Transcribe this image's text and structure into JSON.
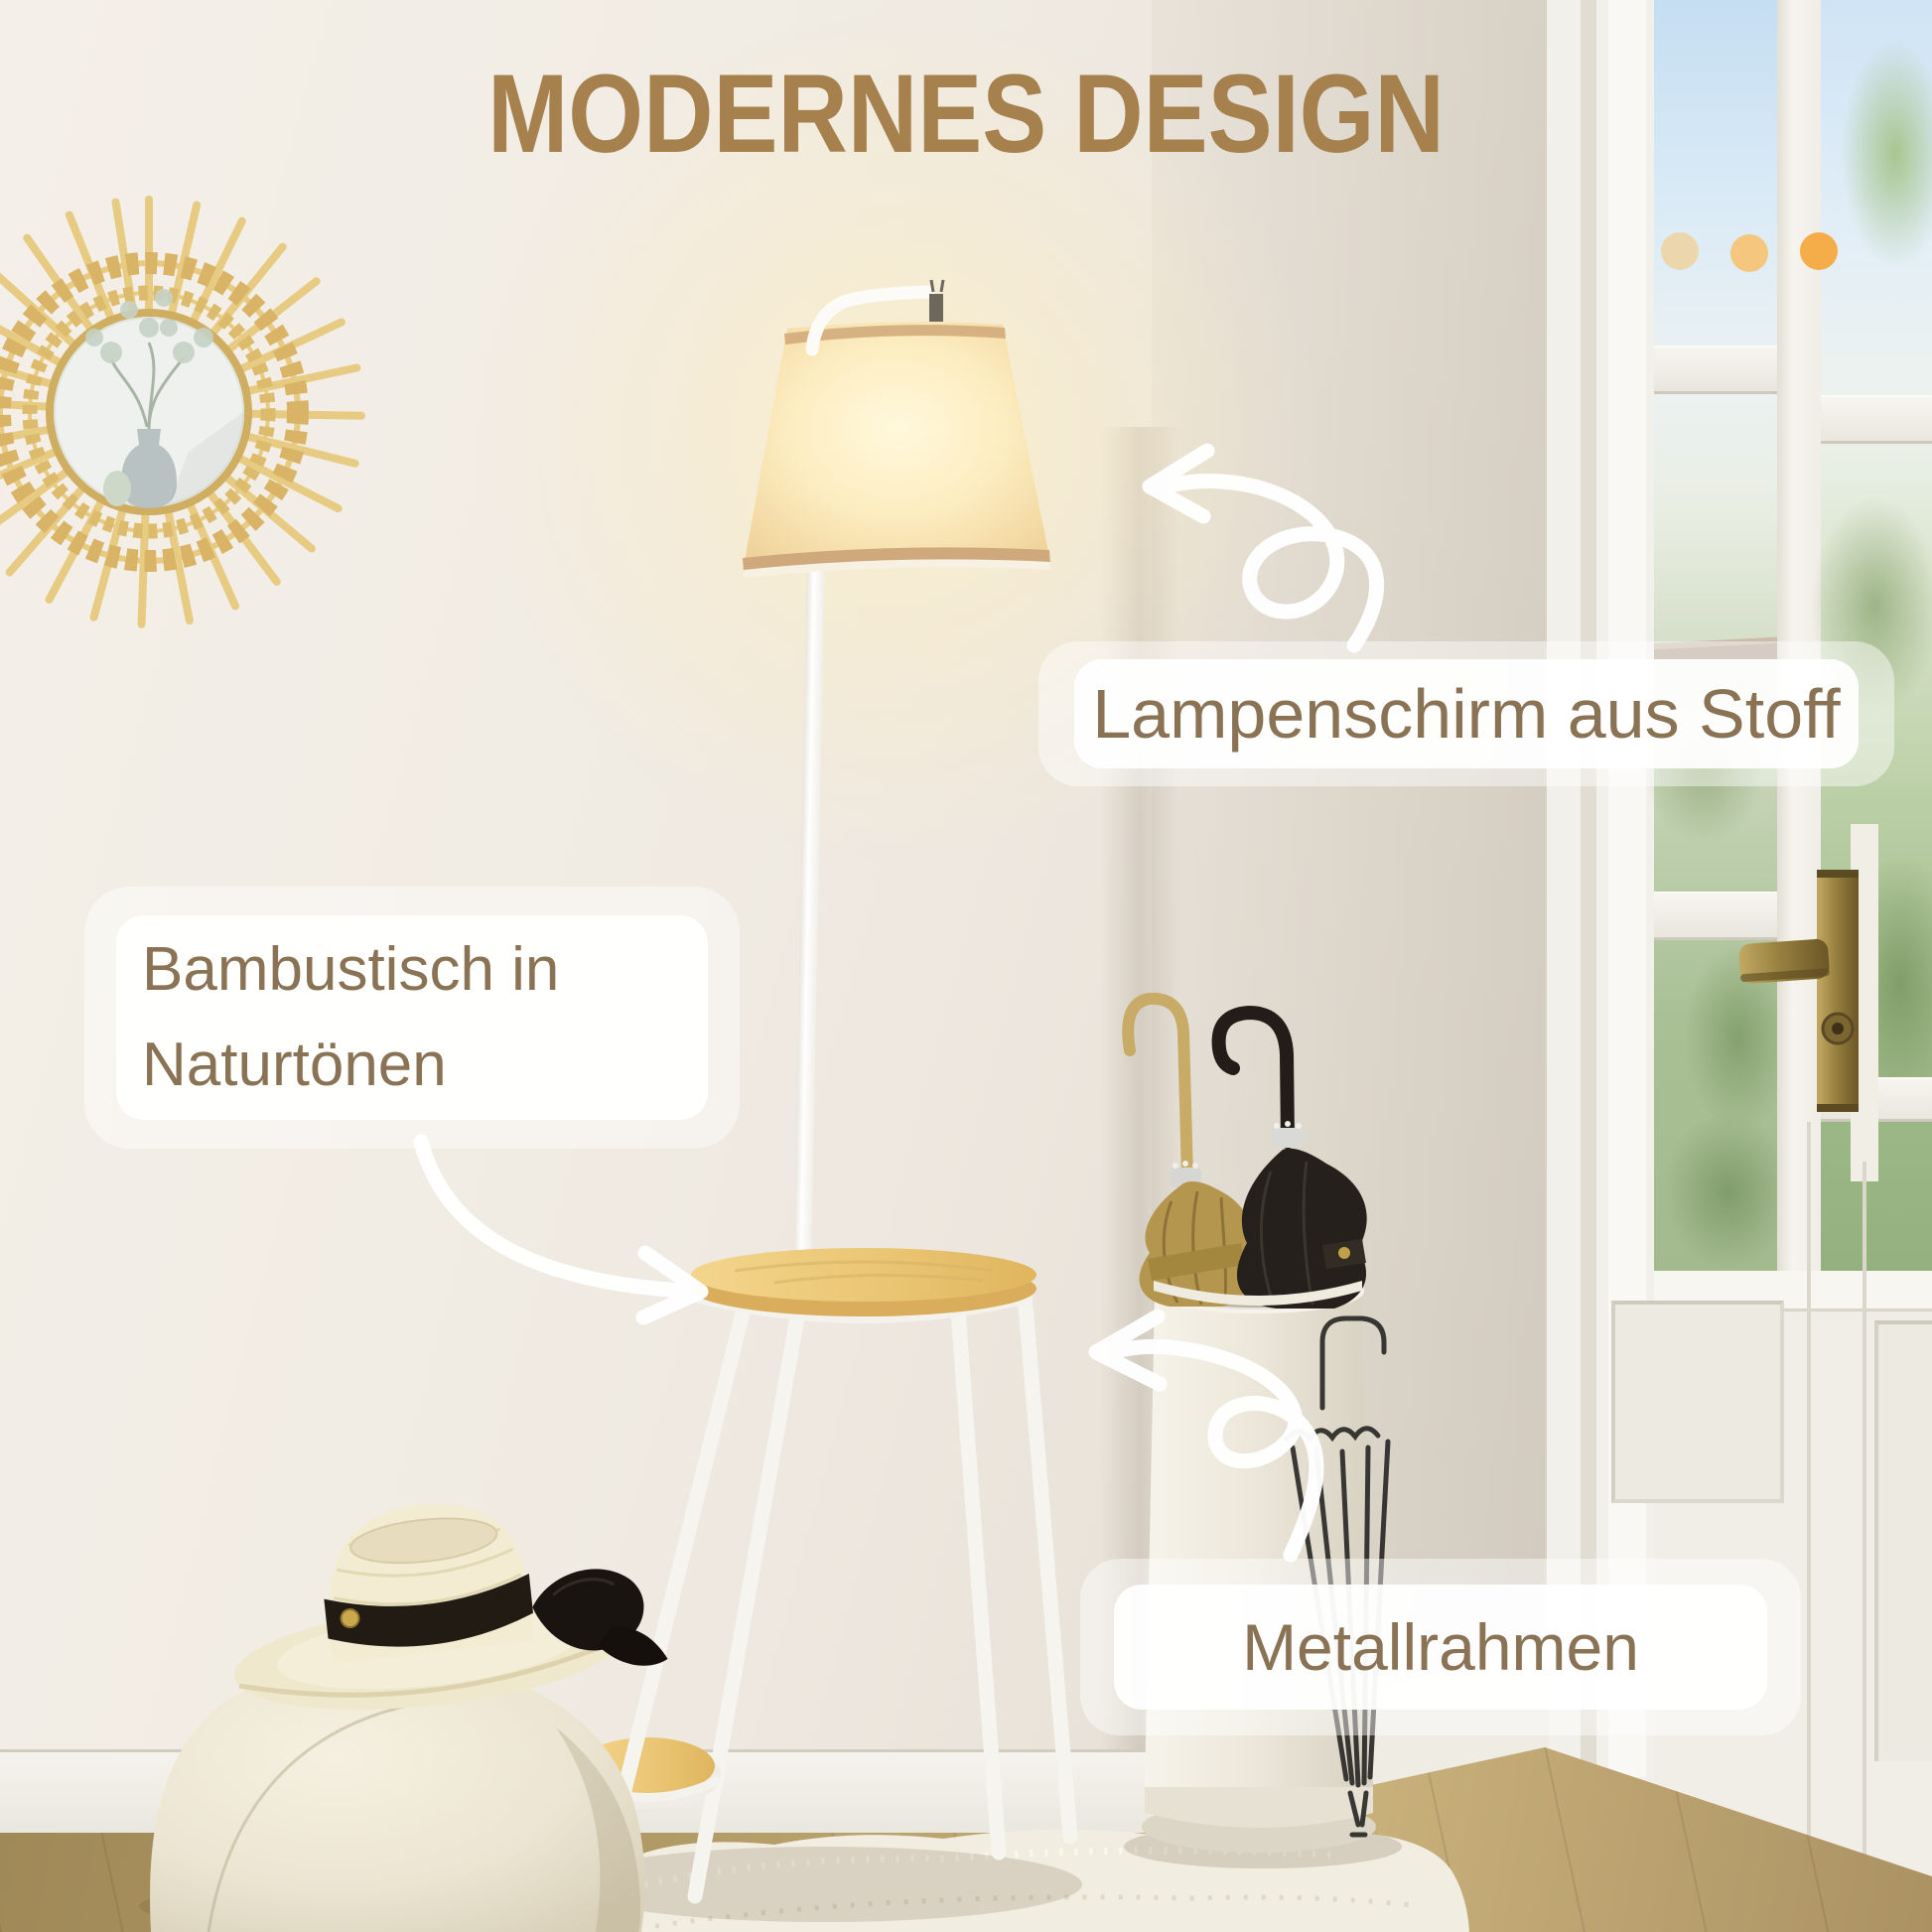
{
  "title": "MODERNES DESIGN",
  "decor_dots": [
    {
      "name": "accent-dot-light",
      "color": "#ecd7ac"
    },
    {
      "name": "accent-dot-medium",
      "color": "#f5c67d"
    },
    {
      "name": "accent-dot-strong",
      "color": "#f5ad4a"
    }
  ],
  "callouts": {
    "lampshade": "Lampenschirm aus Stoff",
    "table": "Bambustisch in Naturtönen",
    "frame": "Metallrahmen"
  },
  "colors": {
    "title": "#a6814e",
    "label_text": "#8a7254",
    "lamp_glow": "#fff3c9",
    "lampshade": "#f8e7b8",
    "bamboo_wood": "#e9c376",
    "metal_white": "#f6f5f1",
    "wall": "#efe9e1",
    "floor_wood": "#b39c6b",
    "brass_handle": "#a3894c",
    "rattan": "#e8cb82"
  }
}
